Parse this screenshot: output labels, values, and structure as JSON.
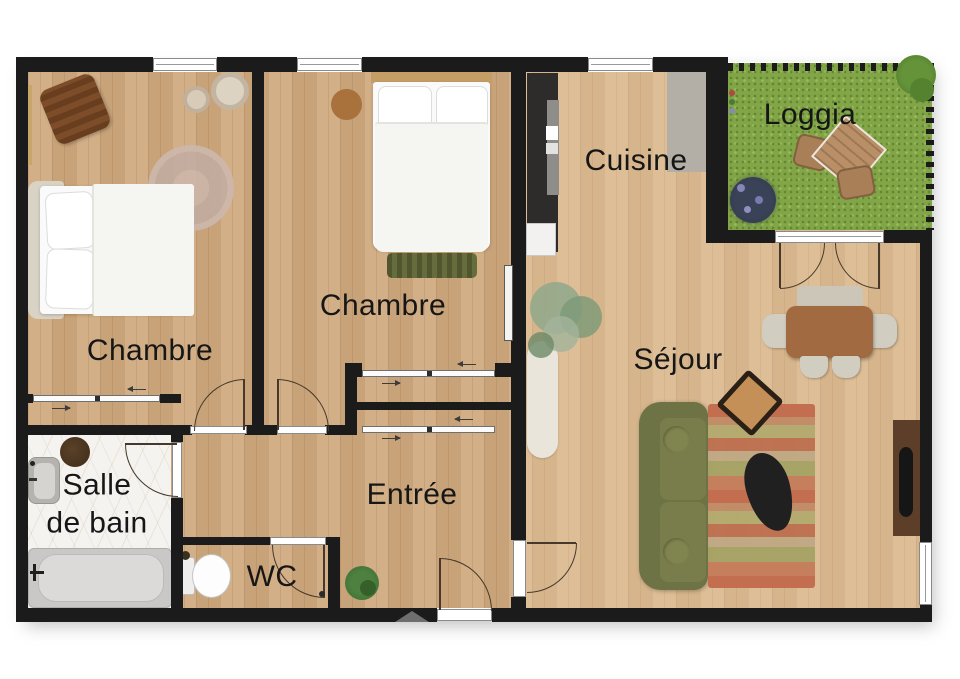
{
  "title": "Plan d'appartement",
  "rooms": {
    "chambre1": {
      "label": "Chambre"
    },
    "chambre2": {
      "label": "Chambre"
    },
    "cuisine": {
      "label": "Cuisine"
    },
    "loggia": {
      "label": "Loggia"
    },
    "sejour": {
      "label": "Séjour"
    },
    "entree": {
      "label": "Entrée"
    },
    "salle_de_bain": {
      "label_line1": "Salle",
      "label_line2": "de bain"
    },
    "wc": {
      "label": "WC"
    }
  },
  "palette": {
    "wall": "#1b1b1b",
    "wood_floor": "#cfa97e",
    "grass": "#82a647",
    "marble": "#f5f3ef",
    "sofa_olive": "#6e7345",
    "rug_terracotta": "#c26a4c",
    "dining_table_brown": "#a26a40",
    "counter_charcoal": "#2e2c2a",
    "tv_console_brown": "#5d3f29",
    "loggia_table_wood": "#b98f68"
  },
  "furniture": [
    "double-bed",
    "double-bed",
    "lounge-chair",
    "round-rug",
    "poufs",
    "bench",
    "kitchen-counter",
    "tall-cabinet",
    "outdoor-table",
    "outdoor-chairs",
    "plants",
    "sofa",
    "striped-rug",
    "coffee-table",
    "side-chair",
    "dining-table",
    "dining-bench",
    "dining-chairs",
    "tv-console",
    "tv",
    "runner-rug",
    "bathtub",
    "sink",
    "stool",
    "toilet",
    "radiators"
  ],
  "openings": [
    "window-top-1",
    "window-top-2",
    "window-kitchen",
    "window-right",
    "french-door-loggia",
    "door-chambre1",
    "door-chambre2",
    "door-bathroom",
    "door-wc",
    "door-sejour",
    "door-entrance",
    "sliding-closet-chambre1",
    "sliding-closet-chambre2",
    "sliding-closet-entree",
    "entrance-marker"
  ]
}
